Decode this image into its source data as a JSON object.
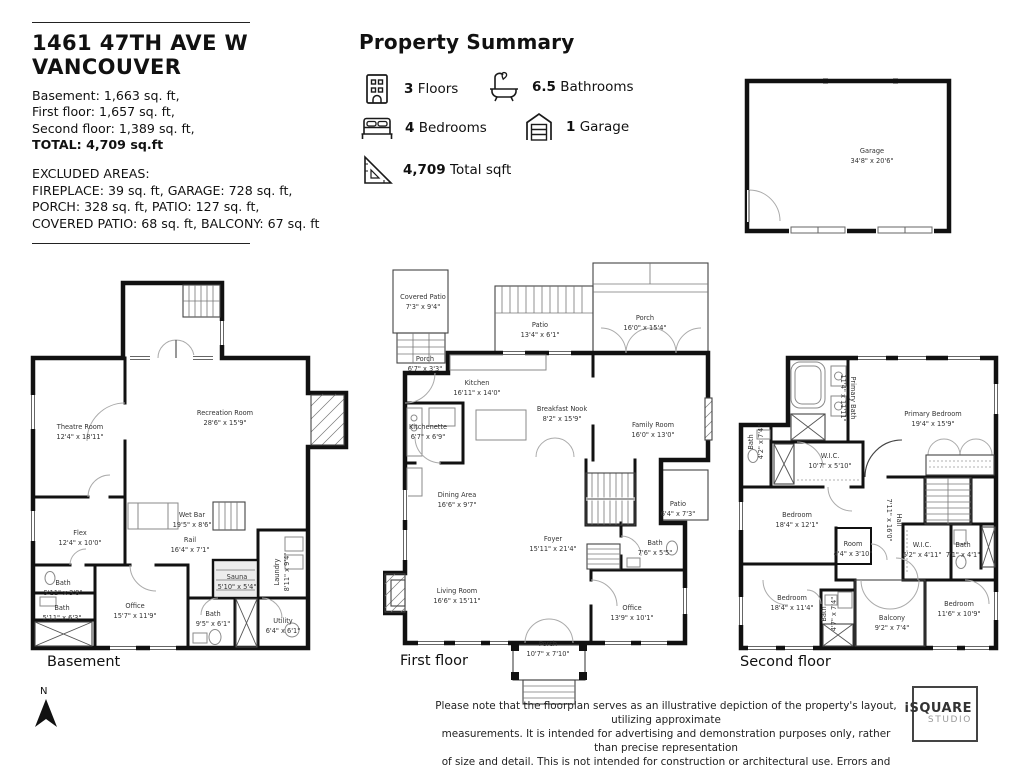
{
  "header": {
    "address_line1": "1461 47TH AVE W",
    "address_line2": "VANCOUVER",
    "area_line1": "Basement: 1,663 sq. ft,",
    "area_line2": "First floor:  1,657 sq. ft,",
    "area_line3": "Second floor: 1,389 sq. ft,",
    "total_line": "TOTAL: 4,709 sq.ft",
    "excluded_title": "EXCLUDED AREAS:",
    "excluded_line1": "FIREPLACE: 39 sq. ft, GARAGE: 728 sq. ft,",
    "excluded_line2": "PORCH: 328 sq. ft, PATIO: 127 sq. ft,",
    "excluded_line3": "COVERED PATIO: 68 sq. ft, BALCONY: 67 sq. ft"
  },
  "summary": {
    "title": "Property Summary",
    "floors_value": "3",
    "floors_label": "Floors",
    "bathrooms_value": "6.5",
    "bathrooms_label": "Bathrooms",
    "bedrooms_value": "4",
    "bedrooms_label": "Bedrooms",
    "garage_value": "1",
    "garage_label": "Garage",
    "total_value": "4,709",
    "total_label": "Total sqft"
  },
  "garage_plan": {
    "name": "Garage",
    "dims": "34'8\" x 20'6\""
  },
  "floors": {
    "basement": {
      "label": "Basement",
      "rooms": [
        {
          "name": "Theatre Room",
          "dims": "12'4\" x 18'11\""
        },
        {
          "name": "Recreation Room",
          "dims": "28'6\" x 15'9\""
        },
        {
          "name": "Flex",
          "dims": "12'4\" x 10'0\""
        },
        {
          "name": "Wet Bar",
          "dims": "19'5\" x 8'6\""
        },
        {
          "name": "Rail",
          "dims": "16'4\" x 7'1\""
        },
        {
          "name": "Bath",
          "dims": "5'11\" x 3'8\""
        },
        {
          "name": "Bath",
          "dims": "5'11\" x 6'3\""
        },
        {
          "name": "Office",
          "dims": "15'7\" x 11'9\""
        },
        {
          "name": "Sauna",
          "dims": "5'10\" x 5'4\""
        },
        {
          "name": "Laundry",
          "dims": "8'11\" x 9'4\""
        },
        {
          "name": "Bath",
          "dims": "9'5\" x 6'1\""
        },
        {
          "name": "Utility",
          "dims": "6'4\" x 6'1\""
        }
      ]
    },
    "first": {
      "label": "First floor",
      "rooms": [
        {
          "name": "Covered Patio",
          "dims": "7'3\" x 9'4\""
        },
        {
          "name": "Porch",
          "dims": "6'7\" x 3'3\""
        },
        {
          "name": "Patio",
          "dims": "13'4\" x 6'1\""
        },
        {
          "name": "Porch",
          "dims": "16'0\" x 15'4\""
        },
        {
          "name": "Kitchen",
          "dims": "16'11\" x 14'0\""
        },
        {
          "name": "Kitchenette",
          "dims": "6'7\" x 6'9\""
        },
        {
          "name": "Breakfast Nook",
          "dims": "8'2\" x 15'9\""
        },
        {
          "name": "Family Room",
          "dims": "16'0\" x 13'0\""
        },
        {
          "name": "Dining Area",
          "dims": "16'6\" x 9'7\""
        },
        {
          "name": "Foyer",
          "dims": "15'11\" x 21'4\""
        },
        {
          "name": "Patio",
          "dims": "6'4\" x 7'3\""
        },
        {
          "name": "Bath",
          "dims": "7'6\" x 5'5\""
        },
        {
          "name": "Living Room",
          "dims": "16'6\" x 15'11\""
        },
        {
          "name": "Office",
          "dims": "13'9\" x 10'1\""
        },
        {
          "name": "Porch",
          "dims": "10'7\" x 7'10\""
        }
      ]
    },
    "second": {
      "label": "Second floor",
      "rooms": [
        {
          "name": "Primary Bath",
          "dims": "11'4\" x 11'11\""
        },
        {
          "name": "Primary Bedroom",
          "dims": "19'4\" x 15'9\""
        },
        {
          "name": "Bath",
          "dims": "4'2\" x 7'4\""
        },
        {
          "name": "W.I.C.",
          "dims": "10'7\" x 5'10\""
        },
        {
          "name": "Bedroom",
          "dims": "18'4\" x 12'1\""
        },
        {
          "name": "Room",
          "dims": "4'4\" x 3'10\""
        },
        {
          "name": "Hall",
          "dims": "7'11\" x 16'0\""
        },
        {
          "name": "W.I.C.",
          "dims": "6'2\" x 4'11\""
        },
        {
          "name": "Bath",
          "dims": "7'1\" x 4'1\""
        },
        {
          "name": "Bedroom",
          "dims": "18'4\" x 11'4\""
        },
        {
          "name": "Bath",
          "dims": "4'7\" x 7'4\""
        },
        {
          "name": "Balcony",
          "dims": "9'2\" x 7'4\""
        },
        {
          "name": "Bedroom",
          "dims": "11'6\" x 10'9\""
        }
      ]
    }
  },
  "footer": {
    "north_label": "N",
    "disclaimer_line1": "Please note that the floorplan serves as an illustrative depiction of the property's layout, utilizing approximate",
    "disclaimer_line2": "measurements.  It is intended for advertising and demonstration purposes only, rather than precise representation",
    "disclaimer_line3": "of size and detail. This is not intended for construction or architectural use. Errors and omissions are insured.",
    "logo_line1": "iSQUARE",
    "logo_line2": "STUDIO"
  }
}
